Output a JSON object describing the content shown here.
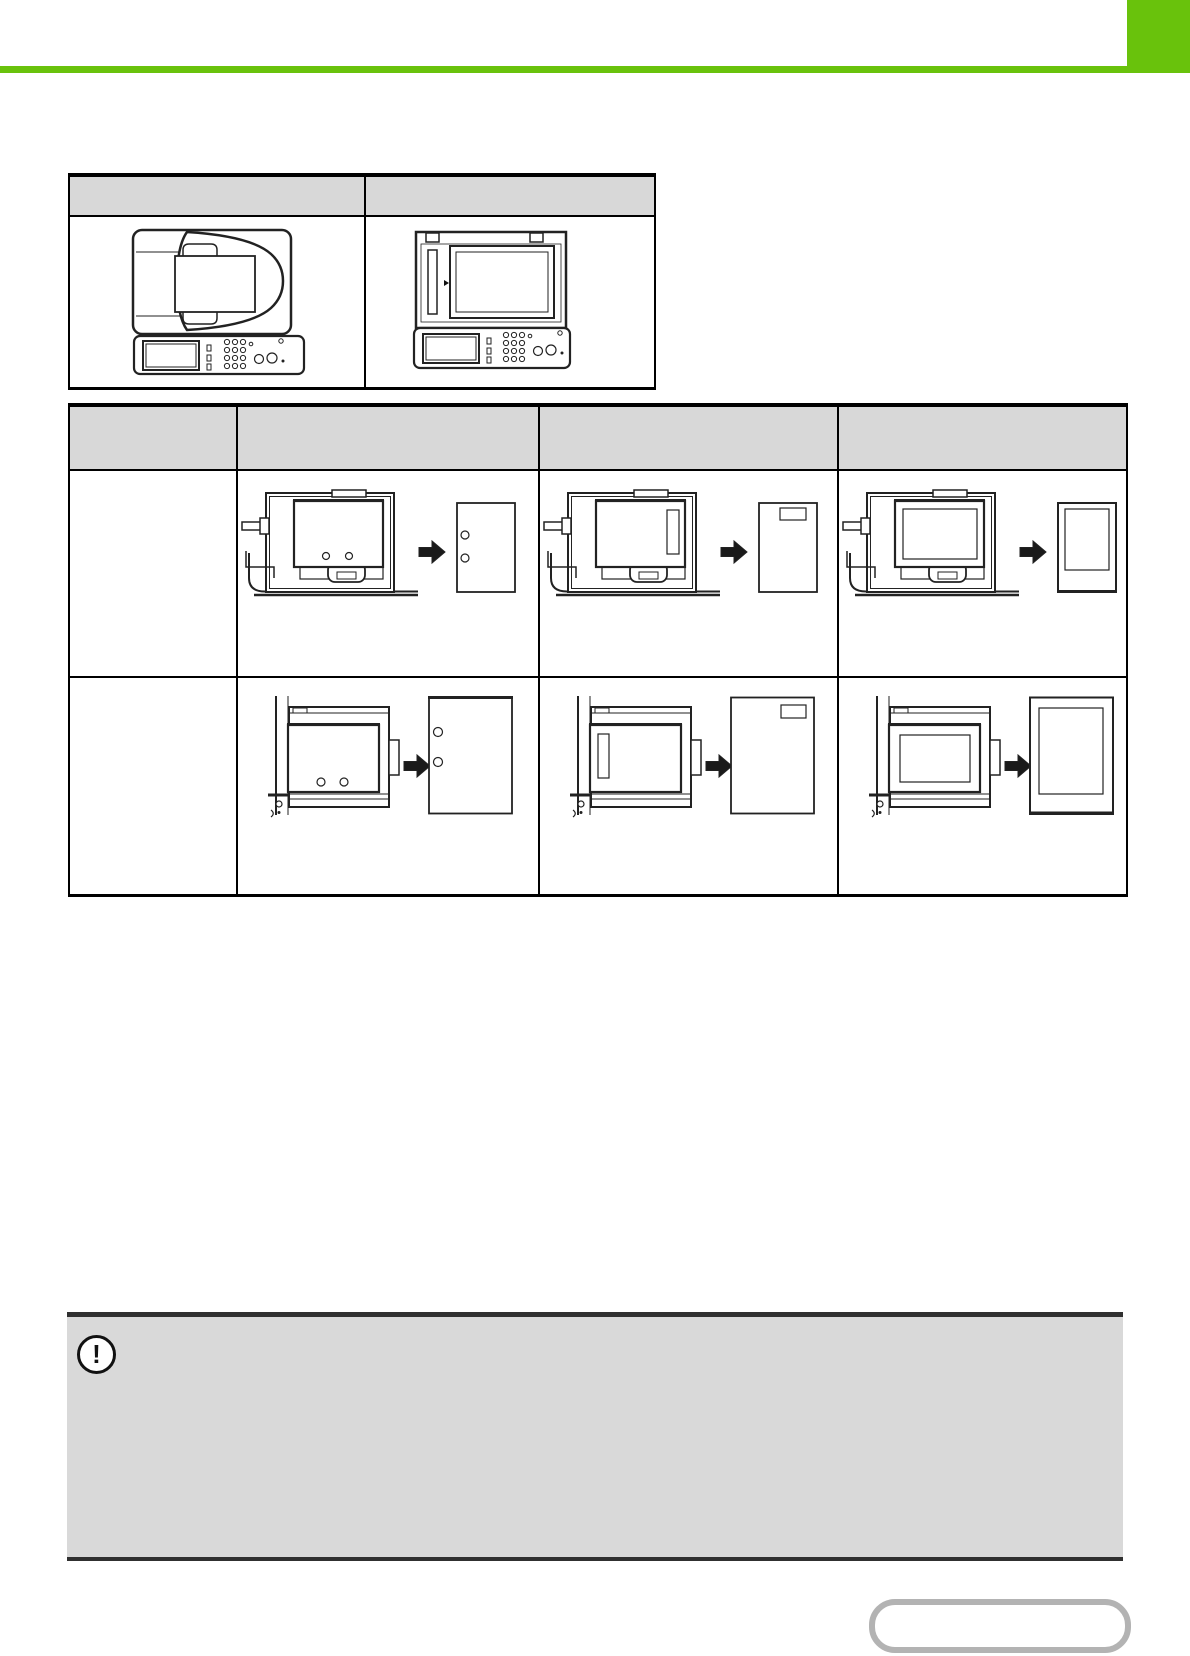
{
  "page": {
    "width": 1190,
    "height": 1656,
    "background": "#ffffff"
  },
  "theme": {
    "accent_green": "#69c20c",
    "table_header_fill": "#d8d8d8",
    "table_border": "#000000",
    "note_fill": "#d9d9d9",
    "note_border": "#303030",
    "line_art": "#222222",
    "button_border": "#b3b3b3"
  },
  "comparison_table": {
    "columns": [
      {
        "label": "",
        "illustration": "machine-with-document-feeder-top-view"
      },
      {
        "label": "",
        "illustration": "machine-document-glass-top-view"
      }
    ]
  },
  "position_table": {
    "corner_label": "",
    "column_labels": [
      "",
      "",
      ""
    ],
    "rows": [
      {
        "label": "",
        "source": "document-feeder",
        "cells": [
          {
            "output": "punch-holes"
          },
          {
            "output": "stamp"
          },
          {
            "output": "frame"
          }
        ]
      },
      {
        "label": "",
        "source": "document-glass",
        "cells": [
          {
            "output": "punch-holes"
          },
          {
            "output": "stamp"
          },
          {
            "output": "frame"
          }
        ]
      }
    ]
  },
  "note": {
    "icon_glyph": "!",
    "text": ""
  },
  "nav_button": {
    "label": ""
  }
}
